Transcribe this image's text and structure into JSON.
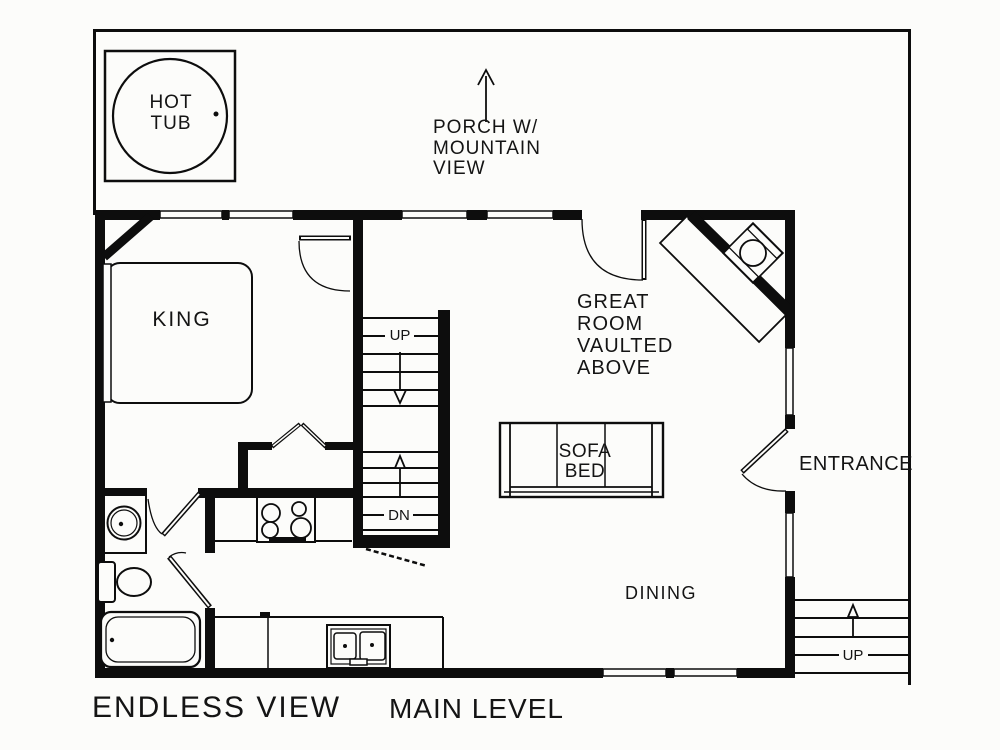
{
  "title": {
    "property_name": "ENDLESS VIEW",
    "level_name": "MAIN LEVEL"
  },
  "rooms": {
    "hot_tub": "HOT\nTUB",
    "porch": "PORCH W/\nMOUNTAIN\nVIEW",
    "bedroom_king": "KING",
    "great_room": "GREAT\nROOM\nVAULTED\nABOVE",
    "sofa_bed": "SOFA\nBED",
    "dining": "DINING",
    "entrance": "ENTRANCE"
  },
  "stairs": {
    "center_up": "UP",
    "center_down": "DN",
    "outer_up": "UP"
  },
  "colors": {
    "line": "#0d0d0d",
    "background": "#fcfcfa",
    "text": "#141414"
  }
}
